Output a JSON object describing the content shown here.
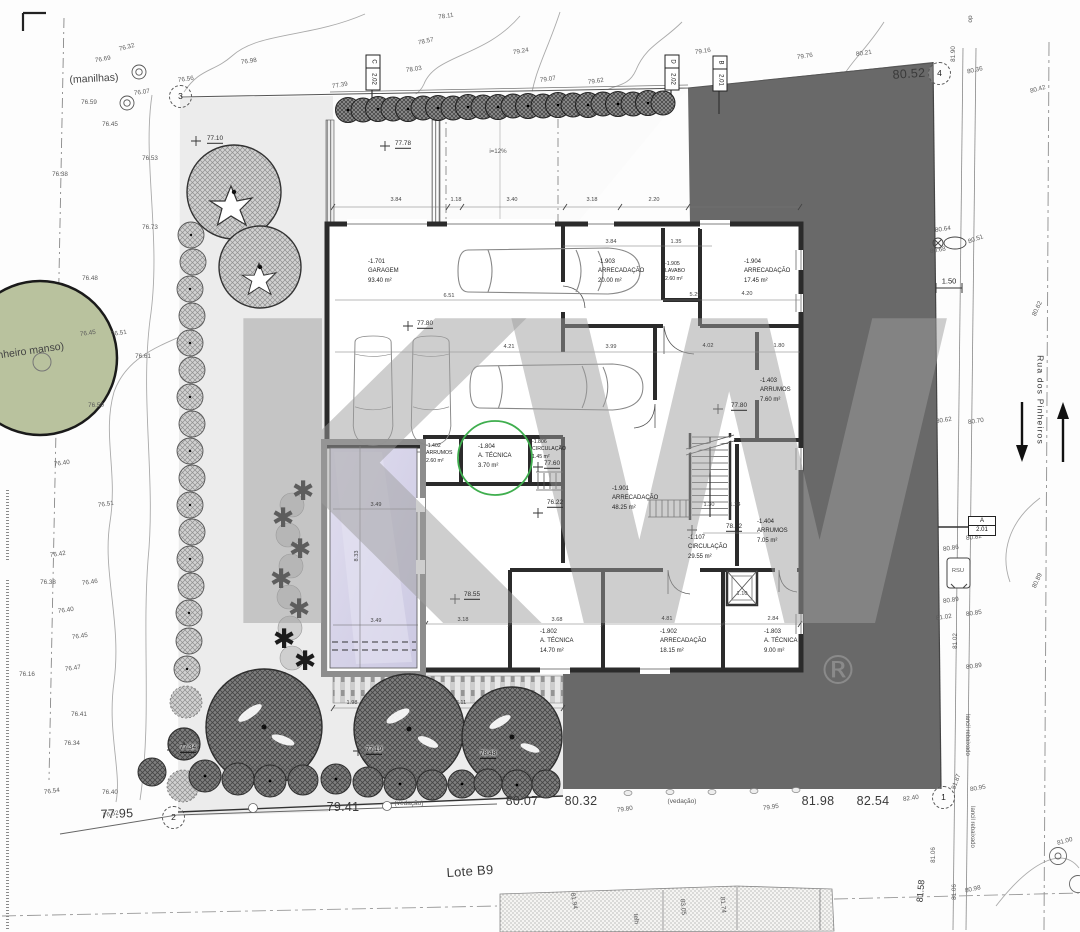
{
  "watermark": {
    "text": "KW",
    "reg": "®"
  },
  "colors": {
    "highlight_green": "#3fae4e",
    "neighbor_fill": "#696969",
    "pool_fill": "#d5d3e6",
    "pine_tree_fill": "#b9c29e",
    "garden_fill": "#ececec"
  },
  "markers": [
    {
      "n": "1",
      "x": 943,
      "y": 797
    },
    {
      "n": "2",
      "x": 173,
      "y": 817
    },
    {
      "n": "3",
      "x": 180,
      "y": 96
    },
    {
      "n": "4",
      "x": 939,
      "y": 73
    }
  ],
  "flags": [
    {
      "l": "C",
      "v": "2.02",
      "x": 372,
      "y": 71,
      "o": "v"
    },
    {
      "l": "D",
      "v": "2.02",
      "x": 671,
      "y": 71,
      "o": "v"
    },
    {
      "l": "B",
      "v": "2.01",
      "x": 719,
      "y": 72,
      "o": "v"
    },
    {
      "l": "A",
      "v": "2.01",
      "x": 981,
      "y": 525,
      "o": "h"
    }
  ],
  "rooms": [
    {
      "code": "-1.701",
      "name": "GARAGEM",
      "area": "93.40 m²",
      "x": 368,
      "y": 258,
      "small": false
    },
    {
      "code": "-1.903",
      "name": "ARRECADAÇÃO",
      "area": "20.00 m²",
      "x": 598,
      "y": 258,
      "small": false
    },
    {
      "code": "-1.905",
      "name": "LAVABO",
      "area": "2.60 m²",
      "x": 665,
      "y": 261,
      "small": true
    },
    {
      "code": "-1.904",
      "name": "ARRECADAÇÃO",
      "area": "17.45 m²",
      "x": 744,
      "y": 258,
      "small": false
    },
    {
      "code": "-1.403",
      "name": "ARRUMOS",
      "area": "7.60 m²",
      "x": 760,
      "y": 377,
      "small": false
    },
    {
      "code": "-1.402",
      "name": "ARRUMOS",
      "area": "2.60 m²",
      "x": 426,
      "y": 443,
      "small": true
    },
    {
      "code": "-1.804",
      "name": "A. TÉCNICA",
      "area": "3.70 m²",
      "x": 478,
      "y": 443,
      "small": false
    },
    {
      "code": "-1.806",
      "name": "CIRCULAÇÃO",
      "area": "1.45 m²",
      "x": 532,
      "y": 439,
      "small": true
    },
    {
      "code": "-1.901",
      "name": "ARRECADAÇÃO",
      "area": "48.25 m²",
      "x": 612,
      "y": 485,
      "small": false
    },
    {
      "code": "-1.107",
      "name": "CIRCULAÇÃO",
      "area": "29.55 m²",
      "x": 688,
      "y": 534,
      "small": false
    },
    {
      "code": "-1.404",
      "name": "ARRUMOS",
      "area": "7.05 m²",
      "x": 757,
      "y": 518,
      "small": false
    },
    {
      "code": "-1.802",
      "name": "A. TÉCNICA",
      "area": "14.70 m²",
      "x": 540,
      "y": 628,
      "small": false
    },
    {
      "code": "-1.902",
      "name": "ARRECADAÇÃO",
      "area": "18.15 m²",
      "x": 660,
      "y": 628,
      "small": false
    },
    {
      "code": "-1.803",
      "name": "A. TÉCNICA",
      "area": "9.00 m²",
      "x": 764,
      "y": 628,
      "small": false
    }
  ],
  "labels": [
    {
      "t": "(manilhas)",
      "x": 94,
      "y": 79,
      "s": 10.5,
      "r": -3,
      "c": "anno",
      "n": "manilhas-label"
    },
    {
      "t": "(pinheiro manso)",
      "x": 25,
      "y": 352,
      "s": 10.5,
      "r": -8,
      "c": "anno",
      "n": "pine-tree-label"
    },
    {
      "t": "(vedação)",
      "x": 409,
      "y": 804,
      "s": 6.5,
      "c": "fine",
      "n": "fence-label"
    },
    {
      "t": "(vedação)",
      "x": 682,
      "y": 802,
      "s": 6.5,
      "c": "fine",
      "n": "fence-label"
    },
    {
      "t": "i=12%",
      "x": 498,
      "y": 152,
      "s": 6.2,
      "c": "fine",
      "n": "ramp-slope-label"
    },
    {
      "t": "Lote B9",
      "x": 470,
      "y": 871,
      "s": 13,
      "r": -4,
      "c": "big",
      "n": "lot-label"
    },
    {
      "t": "Rua dos Pinheiros",
      "x": 1040,
      "y": 400,
      "r": 90,
      "c": "road",
      "n": "street-name"
    },
    {
      "t": "lancil rebaixado",
      "x": 967,
      "y": 735,
      "s": 6,
      "r": 90,
      "n": "curb-label"
    },
    {
      "t": "lancil rebaixado",
      "x": 972,
      "y": 827,
      "s": 6,
      "r": 90,
      "n": "curb-label"
    },
    {
      "t": "RSU",
      "x": 958,
      "y": 572,
      "s": 5.8,
      "n": "rsu-label"
    },
    {
      "t": "telh",
      "x": 635,
      "y": 919,
      "s": 6.5,
      "r": 85,
      "n": "roof-label"
    },
    {
      "t": "81.94",
      "x": 573,
      "y": 901,
      "s": 6.5,
      "r": 80
    },
    {
      "t": "83.05",
      "x": 682,
      "y": 907,
      "s": 6.5,
      "r": 85
    },
    {
      "t": "81.74",
      "x": 722,
      "y": 905,
      "s": 6.5,
      "r": 85
    },
    {
      "t": "81.58",
      "x": 921,
      "y": 891,
      "r": -85,
      "c": "big2"
    },
    {
      "t": "do",
      "x": 969,
      "y": 19,
      "s": 6.5,
      "r": 90
    },
    {
      "t": "77.95",
      "x": 117,
      "y": 814,
      "r": -2,
      "c": "big"
    },
    {
      "t": "79.41",
      "x": 343,
      "y": 807,
      "c": "big"
    },
    {
      "t": "80.07",
      "x": 522,
      "y": 801,
      "c": "big"
    },
    {
      "t": "80.32",
      "x": 581,
      "y": 801,
      "c": "big"
    },
    {
      "t": "81.98",
      "x": 818,
      "y": 801,
      "c": "big"
    },
    {
      "t": "82.54",
      "x": 873,
      "y": 801,
      "c": "big"
    },
    {
      "t": "80.52",
      "x": 909,
      "y": 74,
      "r": -4,
      "c": "big"
    },
    {
      "t": "77.10",
      "x": 215,
      "y": 140,
      "c": "lvl"
    },
    {
      "t": "77.78",
      "x": 403,
      "y": 145,
      "c": "lvl"
    },
    {
      "t": "77.80",
      "x": 425,
      "y": 325,
      "c": "lvl"
    },
    {
      "t": "77.80",
      "x": 739,
      "y": 407,
      "c": "lvl"
    },
    {
      "t": "77.60",
      "x": 552,
      "y": 465,
      "c": "lvl"
    },
    {
      "t": "76.22",
      "x": 555,
      "y": 504,
      "c": "lvl"
    },
    {
      "t": "78.22",
      "x": 734,
      "y": 528,
      "c": "lvl"
    },
    {
      "t": "78.55",
      "x": 472,
      "y": 596,
      "c": "lvl"
    },
    {
      "t": "77.34",
      "x": 188,
      "y": 749,
      "c": "halo"
    },
    {
      "t": "77.19",
      "x": 374,
      "y": 751,
      "c": "halo"
    },
    {
      "t": "78.48",
      "x": 488,
      "y": 755,
      "c": "halo"
    },
    {
      "t": "76.32",
      "x": 127,
      "y": 48,
      "r": -15
    },
    {
      "t": "76.69",
      "x": 103,
      "y": 60,
      "r": -10
    },
    {
      "t": "76.07",
      "x": 142,
      "y": 93,
      "r": -8
    },
    {
      "t": "76.59",
      "x": 89,
      "y": 103
    },
    {
      "t": "76.45",
      "x": 110,
      "y": 125
    },
    {
      "t": "76.56",
      "x": 186,
      "y": 80,
      "r": -8
    },
    {
      "t": "76.98",
      "x": 249,
      "y": 62,
      "r": -8
    },
    {
      "t": "76.53",
      "x": 150,
      "y": 159
    },
    {
      "t": "76.38",
      "x": 60,
      "y": 175
    },
    {
      "t": "77.39",
      "x": 340,
      "y": 86,
      "r": -10
    },
    {
      "t": "76.73",
      "x": 150,
      "y": 228
    },
    {
      "t": "76.48",
      "x": 90,
      "y": 279
    },
    {
      "t": "76.45",
      "x": 88,
      "y": 334,
      "r": -8
    },
    {
      "t": "76.51",
      "x": 119,
      "y": 334,
      "r": -8
    },
    {
      "t": "76.61",
      "x": 143,
      "y": 357
    },
    {
      "t": "76.50",
      "x": 96,
      "y": 406
    },
    {
      "t": "76.40",
      "x": 62,
      "y": 464,
      "r": -8
    },
    {
      "t": "76.51",
      "x": 106,
      "y": 505,
      "r": -8
    },
    {
      "t": "76.42",
      "x": 58,
      "y": 555,
      "r": -8
    },
    {
      "t": "76.38",
      "x": 48,
      "y": 583
    },
    {
      "t": "76.46",
      "x": 90,
      "y": 583,
      "r": -8
    },
    {
      "t": "76.40",
      "x": 66,
      "y": 611,
      "r": -8
    },
    {
      "t": "76.45",
      "x": 80,
      "y": 637,
      "r": -8
    },
    {
      "t": "76.47",
      "x": 73,
      "y": 669,
      "r": -8
    },
    {
      "t": "76.16",
      "x": 27,
      "y": 675
    },
    {
      "t": "76.41",
      "x": 79,
      "y": 715
    },
    {
      "t": "76.34",
      "x": 72,
      "y": 744
    },
    {
      "t": "76.54",
      "x": 52,
      "y": 792,
      "r": -8
    },
    {
      "t": "76.40",
      "x": 110,
      "y": 793
    },
    {
      "t": "76.52",
      "x": 111,
      "y": 815,
      "r": -10
    },
    {
      "t": "78.11",
      "x": 446,
      "y": 17,
      "r": -8
    },
    {
      "t": "78.57",
      "x": 426,
      "y": 42,
      "r": -12
    },
    {
      "t": "79.24",
      "x": 521,
      "y": 52,
      "r": -10
    },
    {
      "t": "78.03",
      "x": 414,
      "y": 70,
      "r": -8
    },
    {
      "t": "79.07",
      "x": 548,
      "y": 80,
      "r": -8
    },
    {
      "t": "79.62",
      "x": 596,
      "y": 82,
      "r": -8
    },
    {
      "t": "79.16",
      "x": 703,
      "y": 52,
      "r": -8
    },
    {
      "t": "79.76",
      "x": 805,
      "y": 57,
      "r": -8
    },
    {
      "t": "80.21",
      "x": 864,
      "y": 54,
      "r": -8
    },
    {
      "t": "80.36",
      "x": 975,
      "y": 71,
      "r": -12
    },
    {
      "t": "80.42",
      "x": 1038,
      "y": 90,
      "r": -15
    },
    {
      "t": "81.90",
      "x": 954,
      "y": 54,
      "r": -90
    },
    {
      "t": "80.64",
      "x": 943,
      "y": 230,
      "r": -8
    },
    {
      "t": "80.68",
      "x": 938,
      "y": 251,
      "r": -10
    },
    {
      "t": "80.51",
      "x": 976,
      "y": 240,
      "r": -20
    },
    {
      "t": "80.62",
      "x": 1038,
      "y": 309,
      "r": -65
    },
    {
      "t": "80.62",
      "x": 944,
      "y": 421,
      "r": -8
    },
    {
      "t": "80.70",
      "x": 976,
      "y": 422,
      "r": -8
    },
    {
      "t": "80.82",
      "x": 974,
      "y": 538,
      "r": -8
    },
    {
      "t": "80.86",
      "x": 951,
      "y": 549,
      "r": -8
    },
    {
      "t": "80.89",
      "x": 951,
      "y": 601,
      "r": -8
    },
    {
      "t": "80.85",
      "x": 974,
      "y": 614,
      "r": -8
    },
    {
      "t": "81.02",
      "x": 944,
      "y": 618,
      "r": -8
    },
    {
      "t": "81.02",
      "x": 956,
      "y": 641,
      "r": -90
    },
    {
      "t": "80.89",
      "x": 974,
      "y": 667,
      "r": -8
    },
    {
      "t": "80.89",
      "x": 1038,
      "y": 581,
      "r": -65
    },
    {
      "t": "81.87",
      "x": 957,
      "y": 782,
      "r": -70
    },
    {
      "t": "80.95",
      "x": 978,
      "y": 789,
      "r": -10
    },
    {
      "t": "82.40",
      "x": 911,
      "y": 799,
      "r": -8
    },
    {
      "t": "79.80",
      "x": 625,
      "y": 810,
      "r": -8
    },
    {
      "t": "79.95",
      "x": 771,
      "y": 808,
      "r": -8
    },
    {
      "t": "81.06",
      "x": 934,
      "y": 855,
      "r": -90
    },
    {
      "t": "81.06",
      "x": 955,
      "y": 892,
      "r": -90
    },
    {
      "t": "80.98",
      "x": 973,
      "y": 890,
      "r": -12
    },
    {
      "t": "81.00",
      "x": 1065,
      "y": 842,
      "r": -15
    },
    {
      "t": "3.84",
      "x": 396,
      "y": 201,
      "c": "dim"
    },
    {
      "t": "1.18",
      "x": 456,
      "y": 201,
      "c": "dim"
    },
    {
      "t": "3.40",
      "x": 512,
      "y": 201,
      "c": "dim"
    },
    {
      "t": "3.18",
      "x": 592,
      "y": 201,
      "c": "dim"
    },
    {
      "t": "2.20",
      "x": 654,
      "y": 201,
      "c": "dim"
    },
    {
      "t": "3.84",
      "x": 611,
      "y": 243,
      "c": "dim"
    },
    {
      "t": "1.35",
      "x": 676,
      "y": 243,
      "c": "dim"
    },
    {
      "t": "6.51",
      "x": 449,
      "y": 297,
      "c": "dim"
    },
    {
      "t": "5.29",
      "x": 695,
      "y": 296,
      "c": "dim"
    },
    {
      "t": "4.20",
      "x": 747,
      "y": 295,
      "c": "dim"
    },
    {
      "t": "4.21",
      "x": 509,
      "y": 348,
      "c": "dim"
    },
    {
      "t": "3.99",
      "x": 611,
      "y": 348,
      "c": "dim"
    },
    {
      "t": "4.02",
      "x": 708,
      "y": 347,
      "c": "dim"
    },
    {
      "t": "1.80",
      "x": 779,
      "y": 347,
      "c": "dim"
    },
    {
      "t": "1.30",
      "x": 709,
      "y": 506,
      "c": "dim"
    },
    {
      "t": "1.24",
      "x": 735,
      "y": 506,
      "c": "dim"
    },
    {
      "t": "3.18",
      "x": 463,
      "y": 621,
      "c": "dim"
    },
    {
      "t": "3.68",
      "x": 557,
      "y": 621,
      "c": "dim"
    },
    {
      "t": "4.81",
      "x": 667,
      "y": 620,
      "c": "dim"
    },
    {
      "t": "2.84",
      "x": 773,
      "y": 620,
      "c": "dim"
    },
    {
      "t": "1.10",
      "x": 742,
      "y": 595,
      "c": "dim"
    },
    {
      "t": "3.49",
      "x": 376,
      "y": 506,
      "c": "dim"
    },
    {
      "t": "3.49",
      "x": 376,
      "y": 622,
      "c": "dim"
    },
    {
      "t": "8.33",
      "x": 358,
      "y": 556,
      "r": -90,
      "c": "dim"
    },
    {
      "t": "1.98",
      "x": 352,
      "y": 704,
      "c": "dim"
    },
    {
      "t": "3.11",
      "x": 461,
      "y": 704,
      "c": "dim"
    },
    {
      "t": "1.50",
      "x": 949,
      "y": 281,
      "c": "dim2",
      "n": "sidewalk-width-dim"
    }
  ]
}
